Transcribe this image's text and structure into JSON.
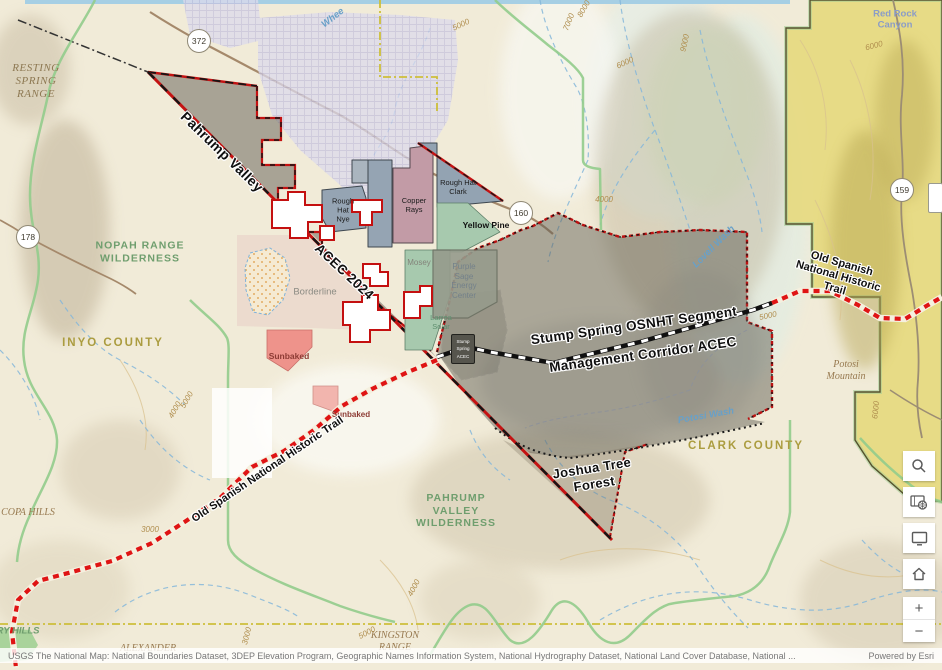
{
  "map": {
    "labels": [
      {
        "text": "RESTING\nSPRING\nRANGE"
      },
      {
        "text": "NOPAH RANGE\nWILDERNESS"
      },
      {
        "text": "INYO COUNTY"
      },
      {
        "text": "Pahrump Valley"
      },
      {
        "text": "ACEC 2024"
      },
      {
        "text": "Rough\nHat\nNye"
      },
      {
        "text": "Copper\nRays"
      },
      {
        "text": "Rough Hat\nClark"
      },
      {
        "text": "Yellow Pine"
      },
      {
        "text": "Mosey"
      },
      {
        "text": "Purple\nSage\nEnergy\nCenter"
      },
      {
        "text": "Larrea\nSolar"
      },
      {
        "text": "Borderline"
      },
      {
        "text": "Sunbaked"
      },
      {
        "text": "Sunbaked"
      },
      {
        "text": "Stump Spring OSNHT Segment"
      },
      {
        "text": "Management Corridor ACEC"
      },
      {
        "text": "Joshua Tree\nForest"
      },
      {
        "text": "Old Spanish National Historic Trail"
      },
      {
        "text": "Old Spanish National Historic Trail"
      },
      {
        "text": "CLARK COUNTY"
      },
      {
        "text": "PAHRUMP\nVALLEY\nWILDERNESS"
      },
      {
        "text": "Potosi\nMountain"
      },
      {
        "text": "Red Rock Canyon"
      },
      {
        "text": "Lovell Wash"
      },
      {
        "text": "Potosi Wash"
      },
      {
        "text": "Whee"
      },
      {
        "text": "ALEXANDER"
      },
      {
        "text": "KINGSTON\nRANGE"
      },
      {
        "text": "COPA HILLS"
      },
      {
        "text": "RY HILLS"
      },
      {
        "text": "5000"
      },
      {
        "text": "7000"
      },
      {
        "text": "8000"
      },
      {
        "text": "6000"
      },
      {
        "text": "9000"
      },
      {
        "text": "6000"
      },
      {
        "text": "4000"
      },
      {
        "text": "5000"
      },
      {
        "text": "4000"
      },
      {
        "text": "3000"
      },
      {
        "text": "3000"
      },
      {
        "text": "4000"
      },
      {
        "text": "5000"
      },
      {
        "text": "6000"
      },
      {
        "text": "5000"
      }
    ],
    "badge": {
      "line1": "Stump",
      "line2": "Spring",
      "line3": "ACEC"
    }
  },
  "shields": [
    {
      "route": "372"
    },
    {
      "route": "178"
    },
    {
      "route": "160"
    },
    {
      "route": "159"
    }
  ],
  "controls": {
    "zoom_in_label": "+",
    "zoom_out_label": "−",
    "icons": [
      "search-icon",
      "basemap-gallery-icon",
      "screenshot-icon",
      "home-icon",
      "zoom-in",
      "zoom-out"
    ]
  },
  "attribution": {
    "sources": "USGS The National Map: National Boundaries Dataset, 3DEP Elevation Program, Geographic Names Information System, National Hydrography Dataset, National Land Cover Database, National ...",
    "powered_by": "Powered by Esri"
  },
  "colors": {
    "boundary_red": "#c41212",
    "trail_red": "#df1414",
    "acec_gray_fill": "#5f5c52",
    "red_rock_yellow": "#e7da7e",
    "wilderness_green": "#92cc8c",
    "county_line_yellow": "#cdbf3a",
    "copper_rays_mauve": "#c29ba6",
    "solar_bluegray": "#95a4b3",
    "solar_green": "#a7c9ae"
  }
}
